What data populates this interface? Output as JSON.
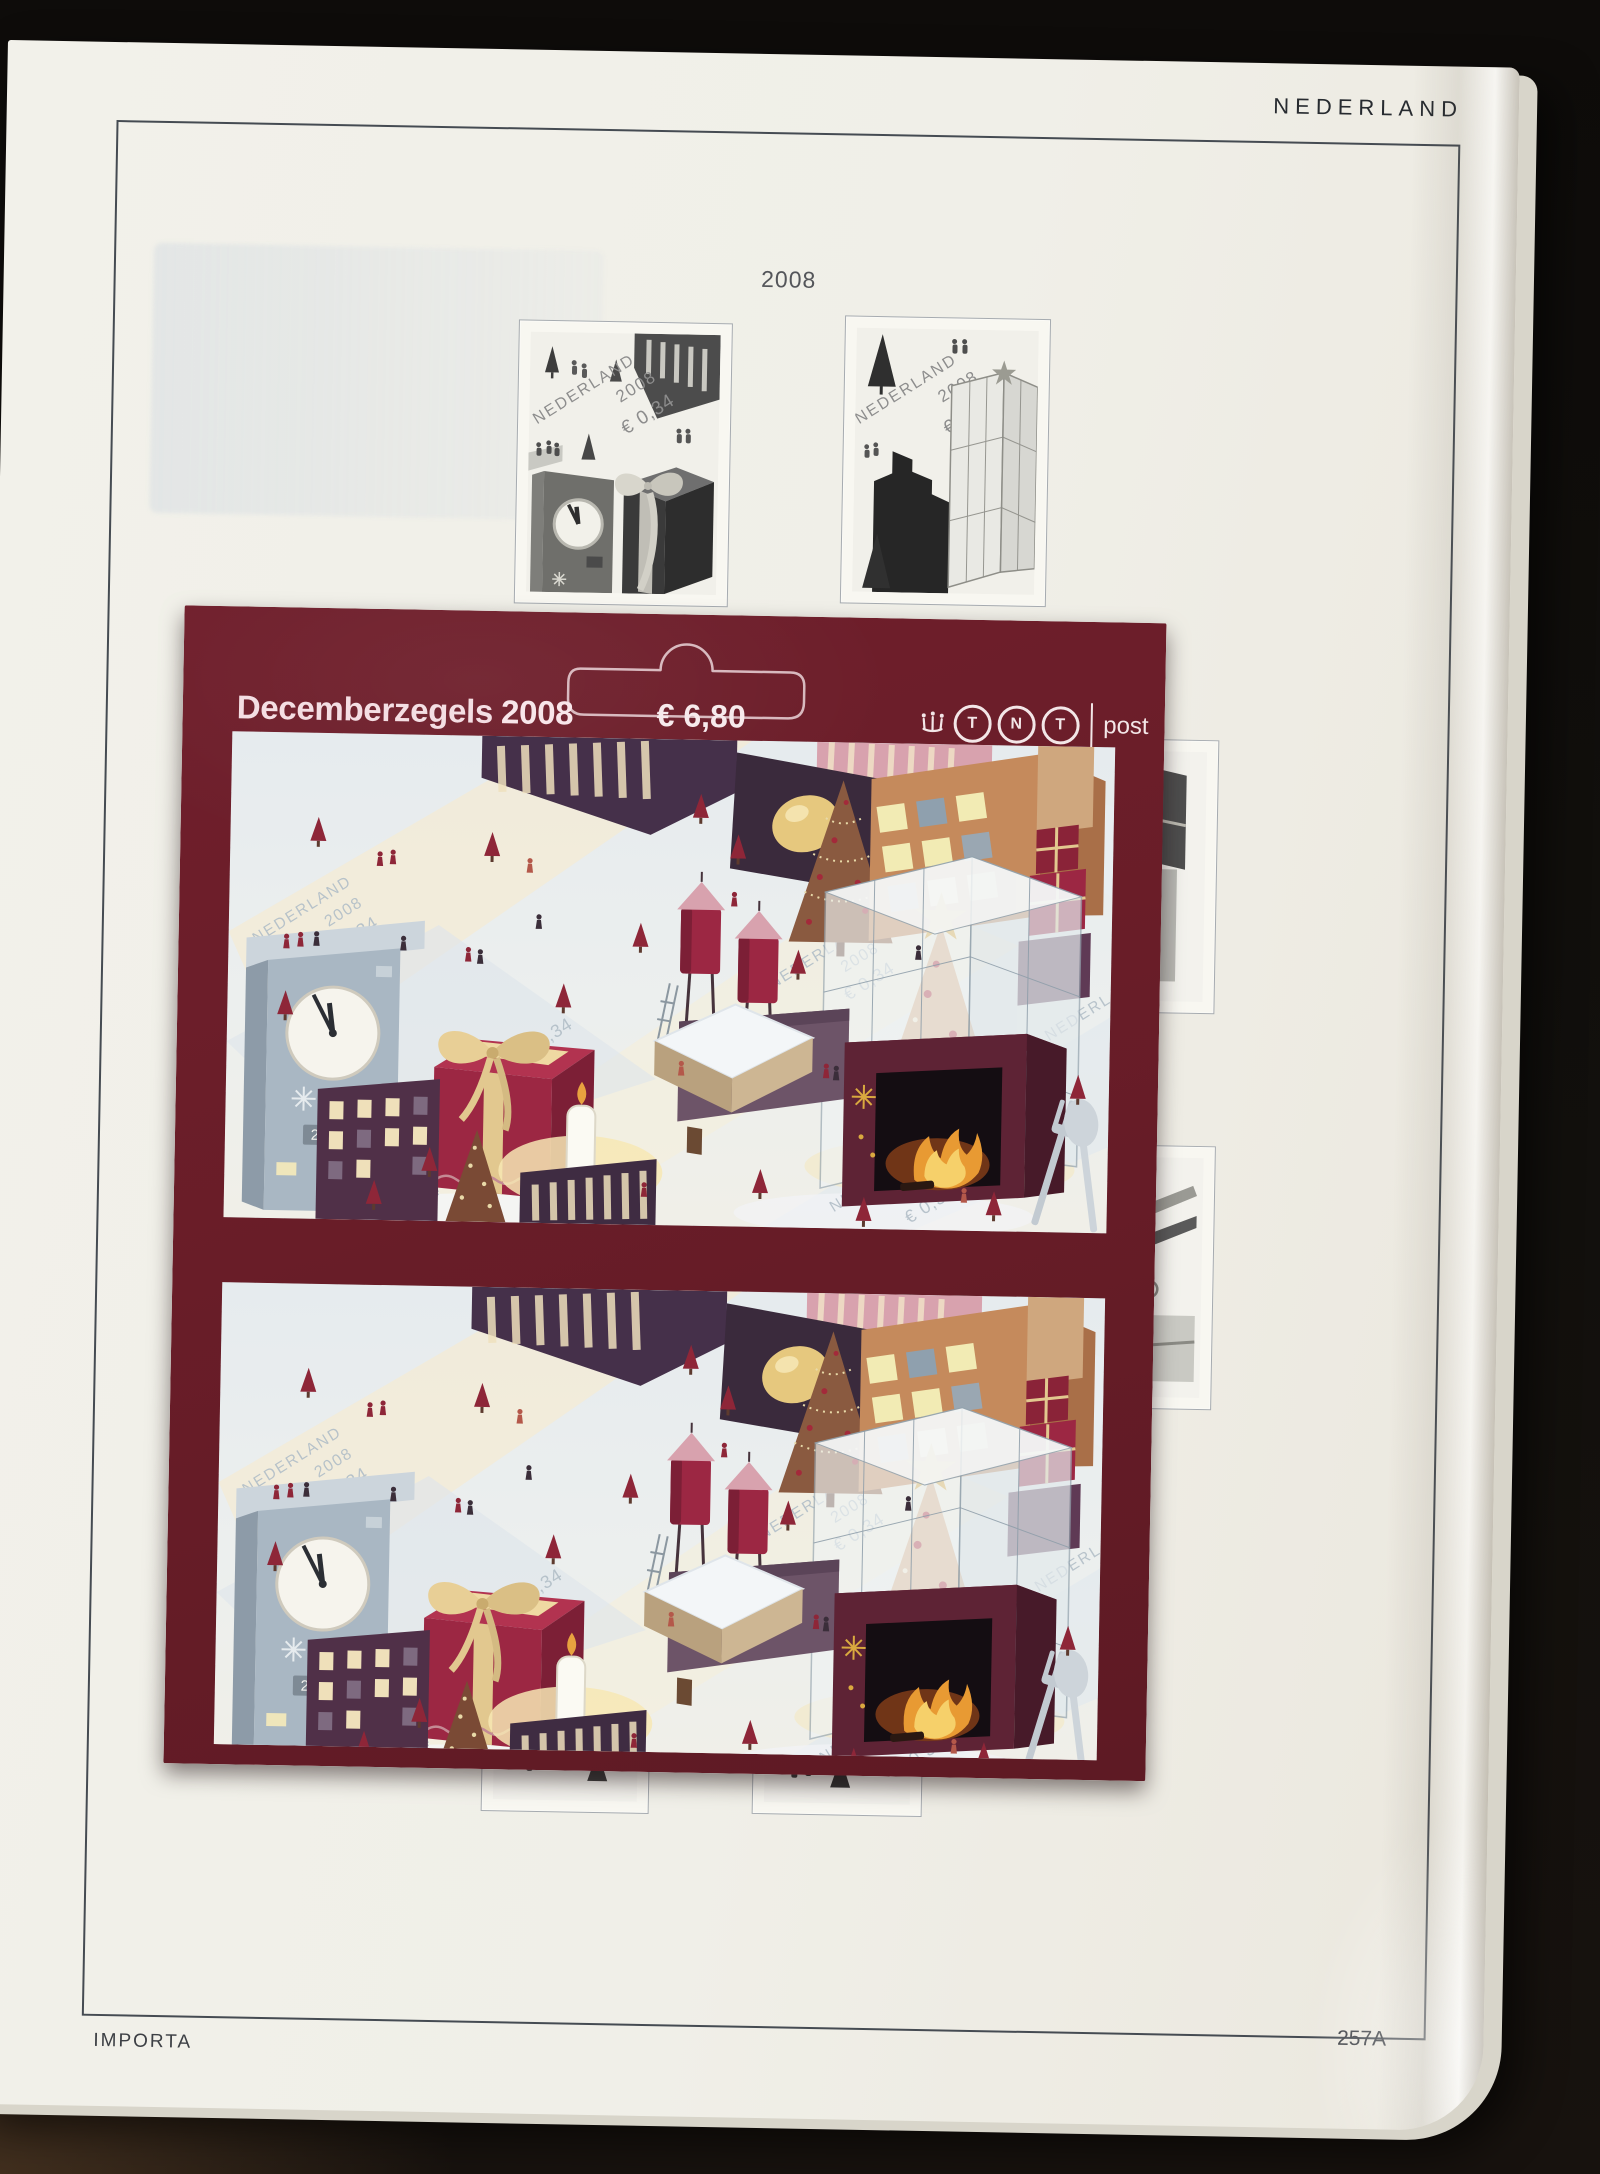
{
  "page": {
    "country_label": "NEDERLAND",
    "year_label": "2008",
    "publisher_label": "IMPORTA",
    "page_number": "257A"
  },
  "booklet": {
    "title": "Decemberzegels",
    "title_year": "2008",
    "price": "€ 6,80",
    "logo": {
      "crown_icon": "tnt-crown",
      "letters": [
        "T",
        "N",
        "T"
      ],
      "suffix": "post"
    }
  },
  "sheet": {
    "watermark_country": "NEDERLAND",
    "watermark_year": "2008",
    "watermark_value": "€ 0,34",
    "clock_display": "23:55"
  },
  "colors": {
    "booklet_maroon": "#6b1e2a",
    "paper_cream": "#f1f0e9",
    "accent_red": "#9c2743",
    "ribbon_gold": "#e2c88f",
    "star_gold": "#d9a93f",
    "frame_line": "#454b52"
  }
}
